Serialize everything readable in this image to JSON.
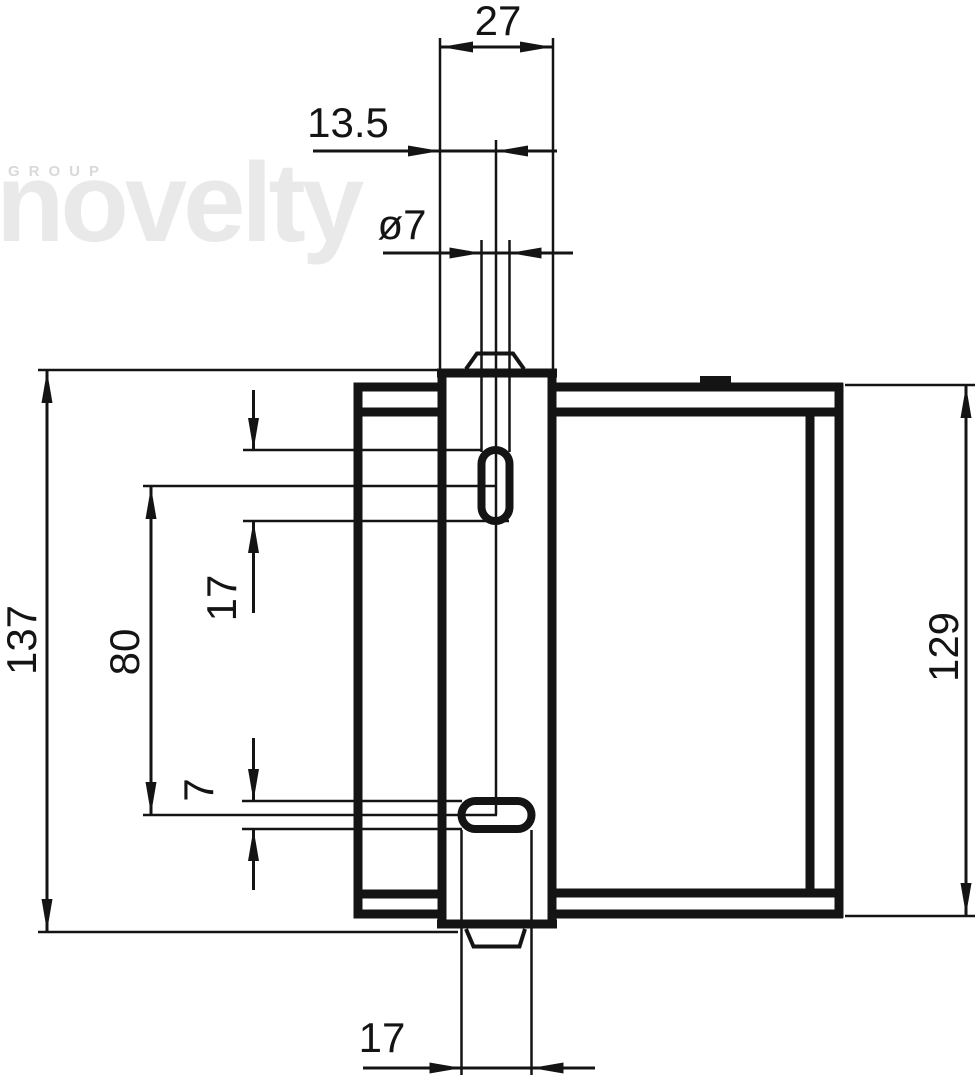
{
  "watermark": {
    "group": "GROUP",
    "name": "novelty"
  },
  "dimensions": {
    "tab_width": "27",
    "hole_offset": "13.5",
    "hole_diameter": "ø7",
    "upper_slot_length": "17",
    "slot_spacing": "80",
    "lower_slot_width": "7",
    "overall_height": "137",
    "frame_height": "129",
    "lower_slot_length": "17"
  },
  "colors": {
    "line": "#141414",
    "watermark_name": "#e9e9e9",
    "watermark_group": "#d9d9d9",
    "background": "#ffffff"
  }
}
